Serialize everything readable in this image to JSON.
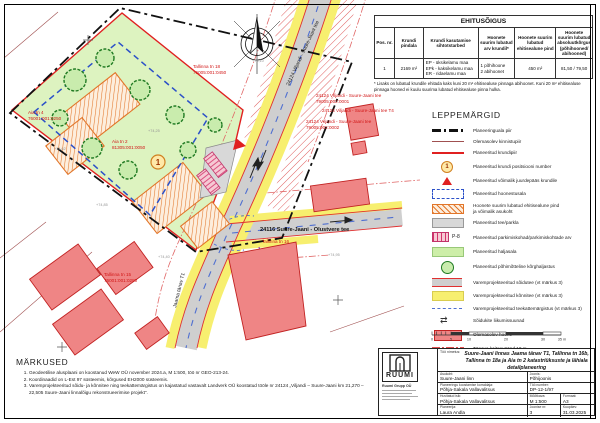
{
  "ehitusoigus": {
    "title": "EHITUSÕIGUS",
    "headers": [
      "Pos. nr.",
      "Krundi pindala",
      "Krundi kasutamise sihtotstarbed",
      "Hoonete suurim lubatud arv krundil*",
      "Hoonete suurim lubatud ehitisealune pind",
      "Hoonete suurim lubatud absoluutkõrgus (põhihooned/ abihooned)"
    ],
    "row": {
      "pos": "1",
      "pindala": "2169 m²",
      "sihtotstarbed": [
        "EP - üksikelamu maa",
        "EPk - kaksikelamu maa",
        "ER - ridaelamu maa"
      ],
      "arv": [
        "1 põhihoone",
        "2 abihoonet"
      ],
      "pind": "450 m²",
      "korgus": "81,50 / 79,50"
    },
    "footnote": "* Lisaks on lubatud krundile ehitada kaks kuni 20 m² ehitisealuse pinnaga abihoonet. Kuni 20 m² ehitisealuse pinnaga hooned ei kuulu suurima lubatud ehitisealuse pinna hulka."
  },
  "leppemargid": {
    "title": "LEPPEMÄRGID",
    "items": [
      {
        "label": "Planeeringuala piir"
      },
      {
        "label": "Olemasolev kinnistupiir"
      },
      {
        "label": "Planeeritud krundipiir"
      },
      {
        "label": "Planeeritud krundi positsiooni number",
        "code": "1"
      },
      {
        "label": "Planeeritud võimalik juurdepääs krundile"
      },
      {
        "label": "Planeeritud hoonestusala"
      },
      {
        "label": "Hoonete suurim lubatud ehitisealune pind",
        "label2": "ja võimalik asukoht"
      },
      {
        "label": "Planeeritud tee/parkla"
      },
      {
        "label": "Planeeritud parkimiskohad/parkimiskohtade arv",
        "code": "P-8"
      },
      {
        "label": "Planeeritud haljasala"
      },
      {
        "label": "Planeeritud põhimõtteline kõrghaljastus"
      },
      {
        "label": "Varemprojekteeritud sõidutee (vt märkus 3)"
      },
      {
        "label": "Varemprojekteeritud kõnnitee (vt märkus 3)"
      },
      {
        "label": "Varemprojekteeritud teekattemärgistus (vt märkus 3)"
      },
      {
        "label": "Sõidukite liikumissuunad",
        "glyph": "⇄"
      },
      {
        "label": "Olemasolev hoone"
      },
      {
        "label": "Tänava kaitsevöönd 10 m"
      },
      {
        "label": "Nähtavuskolmnurk"
      }
    ]
  },
  "markused": {
    "title": "MÄRKUSED",
    "notes": [
      "Geodeetilise alusplaani on koostanud WeW OÜ november 2024.a, M 1:500, töö nr GEO-213-24.",
      "Koordinaadid on L-Est 97 süsteemis, kõrgused EH2000 süsteemis.",
      "Varemprojekteeritud sõidu- ja kõnnitee ning teekattemärgistus on kajastatud vastavalt Landverk OÜ koostatud tööle nr 24124 „Viljandi – Suure-Jaani km 21,270 – 22,505 Suure-Jaani linnalõigu rekonstrueerimise projekt”."
    ]
  },
  "scale_bar": {
    "labels": [
      "0",
      "5",
      "10",
      "20",
      "30",
      "35 m"
    ]
  },
  "title_block": {
    "logo_text": "RUUMI",
    "company": "Ruumi Grupp OÜ",
    "too_nimetus_label": "Töö nimetus:",
    "project_title": "Suure-Jaani linnas Jaama tänav T1, Tallinna tn 16b, Tallinna tn 18a ja Aia tn 2 katastriüksuste ja lähiala detailplaneering",
    "asukoht_label": "Asukoht:",
    "asukoht": "Suure-Jaani linn",
    "joonis_label": "Joonis:",
    "joonis": "Põhijoonis",
    "korraldaja_label": "Planeeringu koostamise korraldaja:",
    "korraldaja": "Põhja-Sakala Vallavalitsus",
    "too_number_label": "Töö number:",
    "too_number": "DP-12-1/97",
    "huvitatud_label": "Huvitatud isik:",
    "huvitatud": "Põhja-Sakala Vallavalitsus",
    "mootkava_label": "Mõõtkava:",
    "mootkava": "M 1:500",
    "formaat_label": "Formaat:",
    "formaat": "A3",
    "planeerija_label": "Planeerija:",
    "planeerija": "Laura Andla",
    "joonise_nr_label": "Joonise nr:",
    "joonise_nr": "3",
    "kuupaev_label": "Kuupäev:",
    "kuupaev": "31.03.2025"
  },
  "map": {
    "pos_number": "1",
    "road_cross_label": "24116 Suure-Jaani - Olustvere tee",
    "road_main_label": "24124 Viljandi - Suure-Jaani tee",
    "road_jaama_label": "Jaama tänav T1",
    "road_labels": [
      {
        "name": "24124 Viljandi - Suure-Jaani tee",
        "cad": "79005:002:0001"
      },
      {
        "name": "24124 Viljandi - Suure-Jaani tee T4"
      },
      {
        "name": "24124 Viljandi - Suure-Jaani tee",
        "cad": "79005:002:0002"
      }
    ],
    "parcels": [
      {
        "name": "Aia tn 4",
        "cad": "76001:001:0250"
      },
      {
        "name": "Aia tn 2",
        "cad": "81305:001:0050"
      },
      {
        "name": "Tallinna tn 18",
        "cad": "76005:001:0450"
      },
      {
        "name": "Tallinna tn 15",
        "cad": "76001:001:0280"
      },
      {
        "name": "Tallinna tn 16"
      }
    ],
    "elevations": [
      "+74,25",
      "+74,62",
      "+74,85",
      "+75,10",
      "+74,40",
      "+74,95"
    ]
  }
}
